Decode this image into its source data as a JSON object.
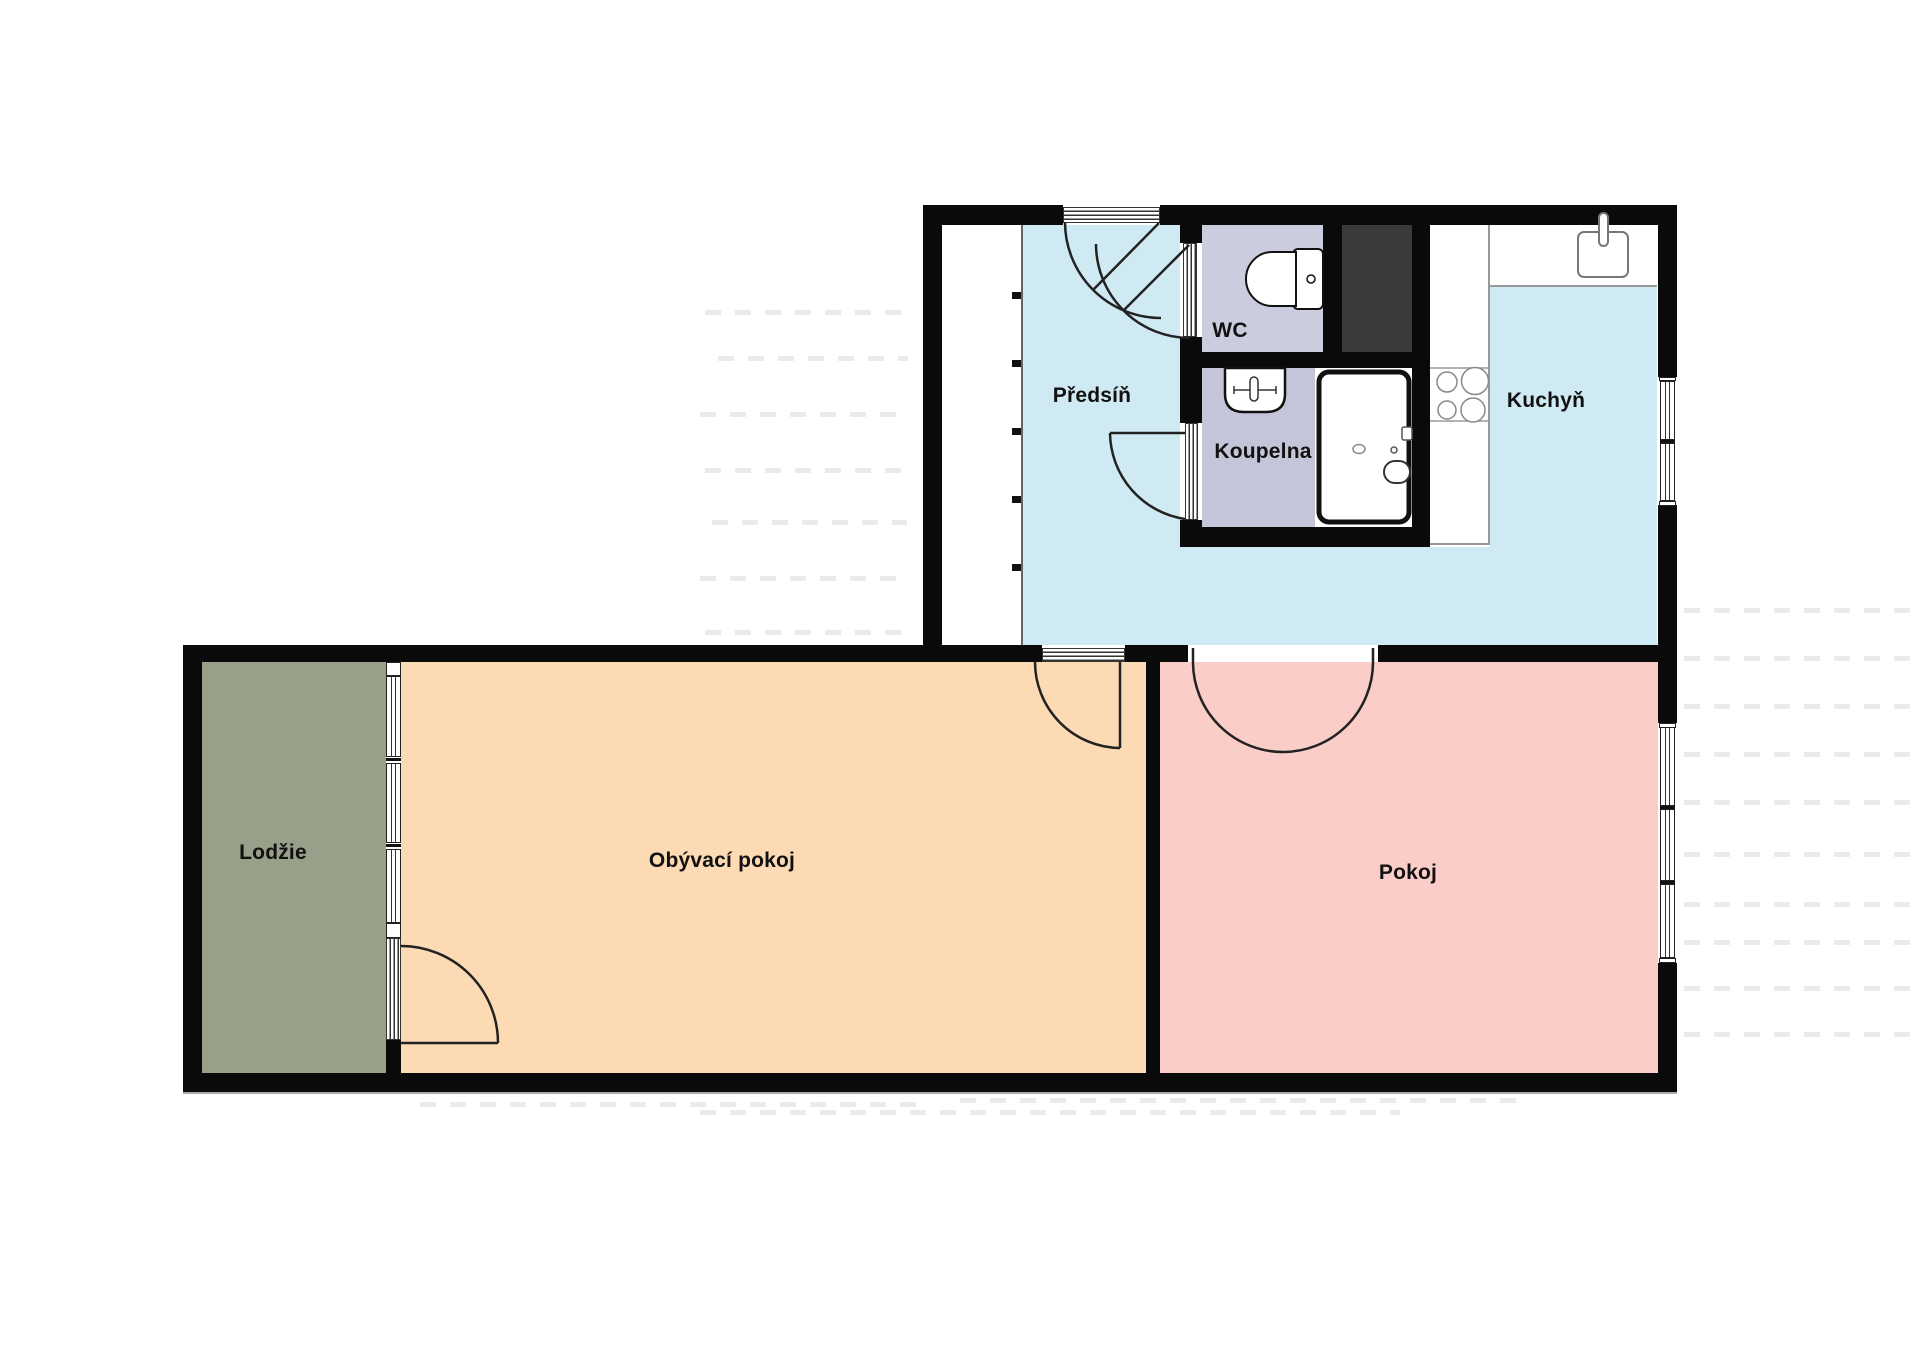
{
  "plan_title": "Apartment floor plan",
  "rooms": [
    {
      "id": "predsin",
      "label": "Předsíň",
      "color": "#cfeaf2"
    },
    {
      "id": "wc",
      "label": "WC",
      "color": "#ccccdf"
    },
    {
      "id": "koupelna",
      "label": "Koupelna",
      "color": "#c5c5da"
    },
    {
      "id": "kuchyn",
      "label": "Kuchyň",
      "color": "#cfeaf2"
    },
    {
      "id": "lodzie",
      "label": "Lodžie",
      "color": "#99a089"
    },
    {
      "id": "obyvaci",
      "label": "Obývací pokoj",
      "color": "#fbdab4"
    },
    {
      "id": "pokoj",
      "label": "Pokoj",
      "color": "#fbcdc8"
    }
  ],
  "fixtures": [
    "toilet",
    "washbasin",
    "bathtub",
    "kitchen-sink",
    "stove-hob",
    "built-in-closet",
    "utility-shaft"
  ],
  "palette": {
    "wall": "#0a0a0a",
    "shaft": "#3a3a3a",
    "background": "#ffffff",
    "corridor": "#cfeaf2",
    "counter_edge": "#999999",
    "label_text": "#111111"
  }
}
